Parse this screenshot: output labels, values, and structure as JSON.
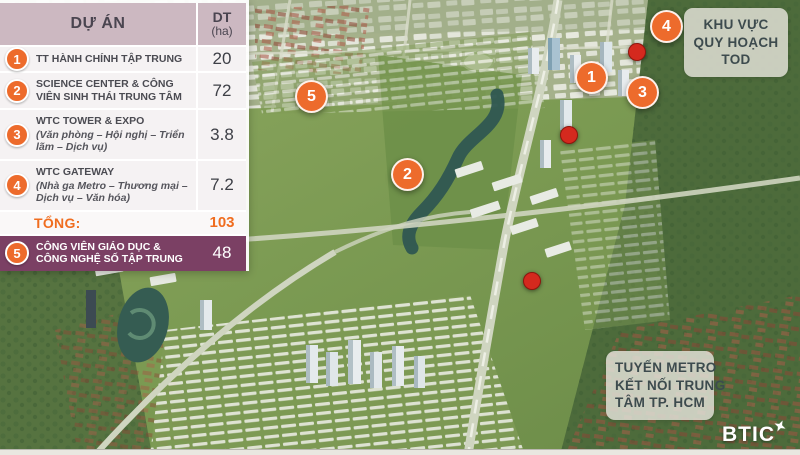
{
  "legend": {
    "header": {
      "project": "DỰ ÁN",
      "dt": "DT",
      "unit": "(ha)"
    },
    "rows": [
      {
        "num": "1",
        "title": "TT HÀNH CHÍNH TẬP TRUNG",
        "area": "20"
      },
      {
        "num": "2",
        "title": "SCIENCE CENTER & CÔNG VIÊN SINH THÁI TRUNG TÂM",
        "area": "72"
      },
      {
        "num": "3",
        "title": "WTC TOWER & EXPO",
        "subtitle": "(Văn phòng – Hội nghị – Triển lãm – Dịch vụ)",
        "area": "3.8"
      },
      {
        "num": "4",
        "title": "WTC GATEWAY",
        "subtitle": "(Nhà ga Metro – Thương mại – Dịch vụ – Văn hóa)",
        "area": "7.2"
      }
    ],
    "total": {
      "label": "TỔNG:",
      "value": "103"
    },
    "row5": {
      "num": "5",
      "title": "CÔNG VIÊN GIÁO DỤC & CÔNG NGHỆ SỐ TẬP TRUNG",
      "area": "48"
    }
  },
  "callouts": {
    "tod": {
      "lines": [
        "KHU VỰC",
        "QUY HOẠCH",
        "TOD"
      ]
    },
    "metro": {
      "lines": [
        "TUYẾN METRO",
        "KẾT NỐI TRUNG",
        "TÂM TP. HCM"
      ]
    }
  },
  "markers": [
    {
      "label": "1"
    },
    {
      "label": "2"
    },
    {
      "label": "3"
    },
    {
      "label": "4"
    },
    {
      "label": "5"
    }
  ],
  "logo": {
    "text": "BTIC"
  },
  "colors": {
    "accent_orange": "#ED6B2C",
    "station_red": "#D4291E",
    "header_mauve": "#CCB8C1",
    "row5_purple": "#7B4064",
    "total_orange": "#F06D1F"
  }
}
